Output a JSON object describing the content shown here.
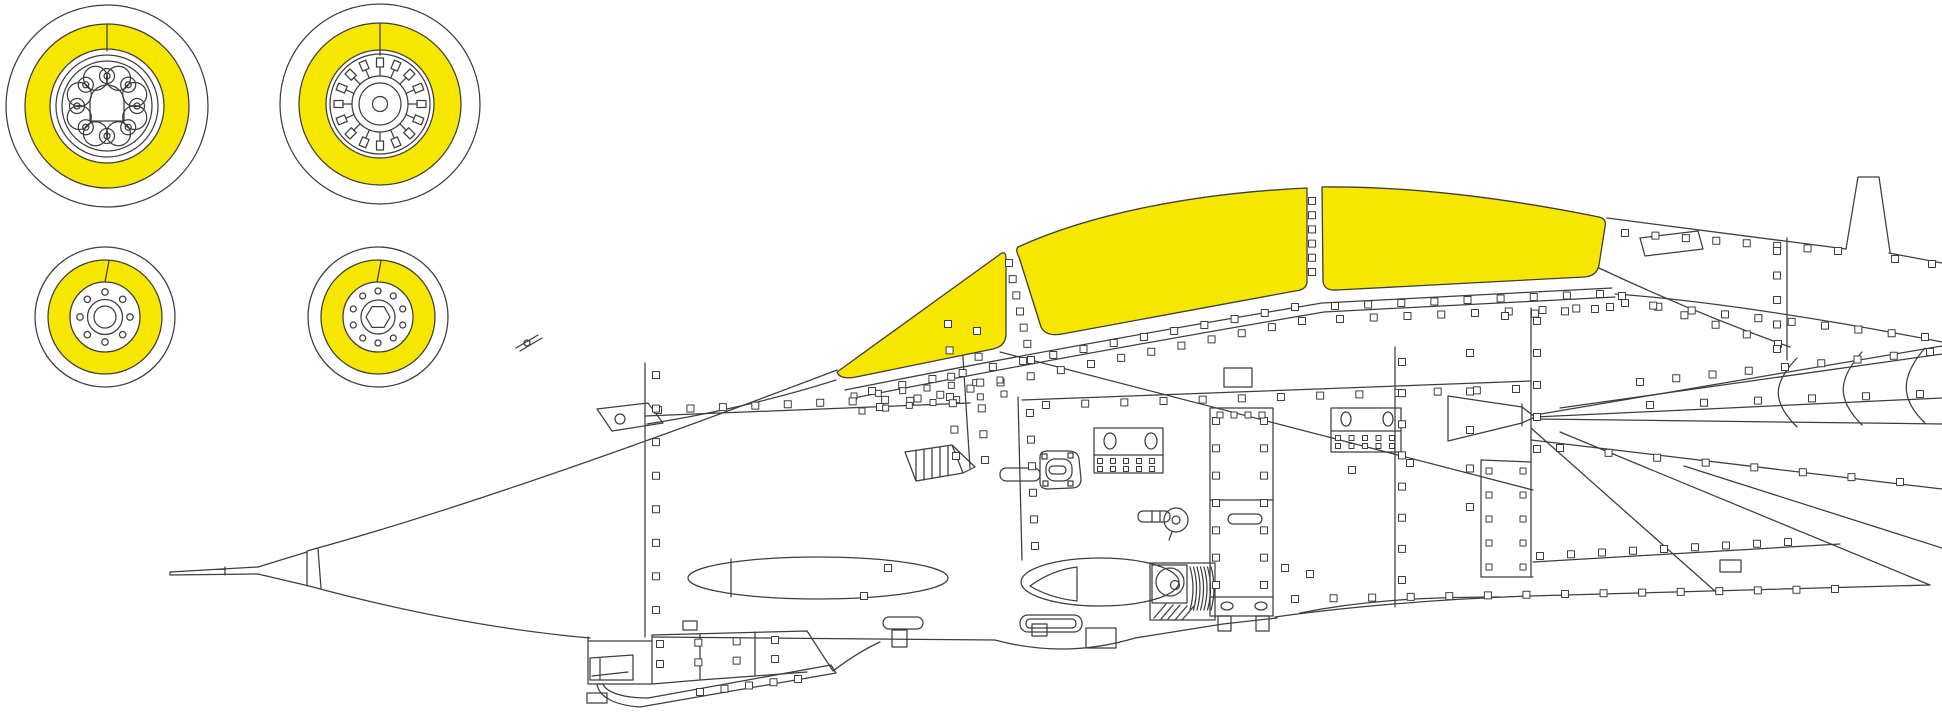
{
  "page": {
    "background": "#ffffff",
    "description": "Paint-mask placement diagram: aircraft side profile with yellow canopy masks and four yellow wheel-hub masks"
  },
  "palette": {
    "mask_yellow": "#f7e600",
    "line": "#3d3d3d",
    "white": "#ffffff"
  },
  "masks": {
    "canopy_sections": [
      "windscreen",
      "canopy-forward",
      "canopy-rear"
    ],
    "wheel_masks": [
      "main-wheel-a",
      "main-wheel-b",
      "nose-wheel-a",
      "nose-wheel-b"
    ]
  }
}
